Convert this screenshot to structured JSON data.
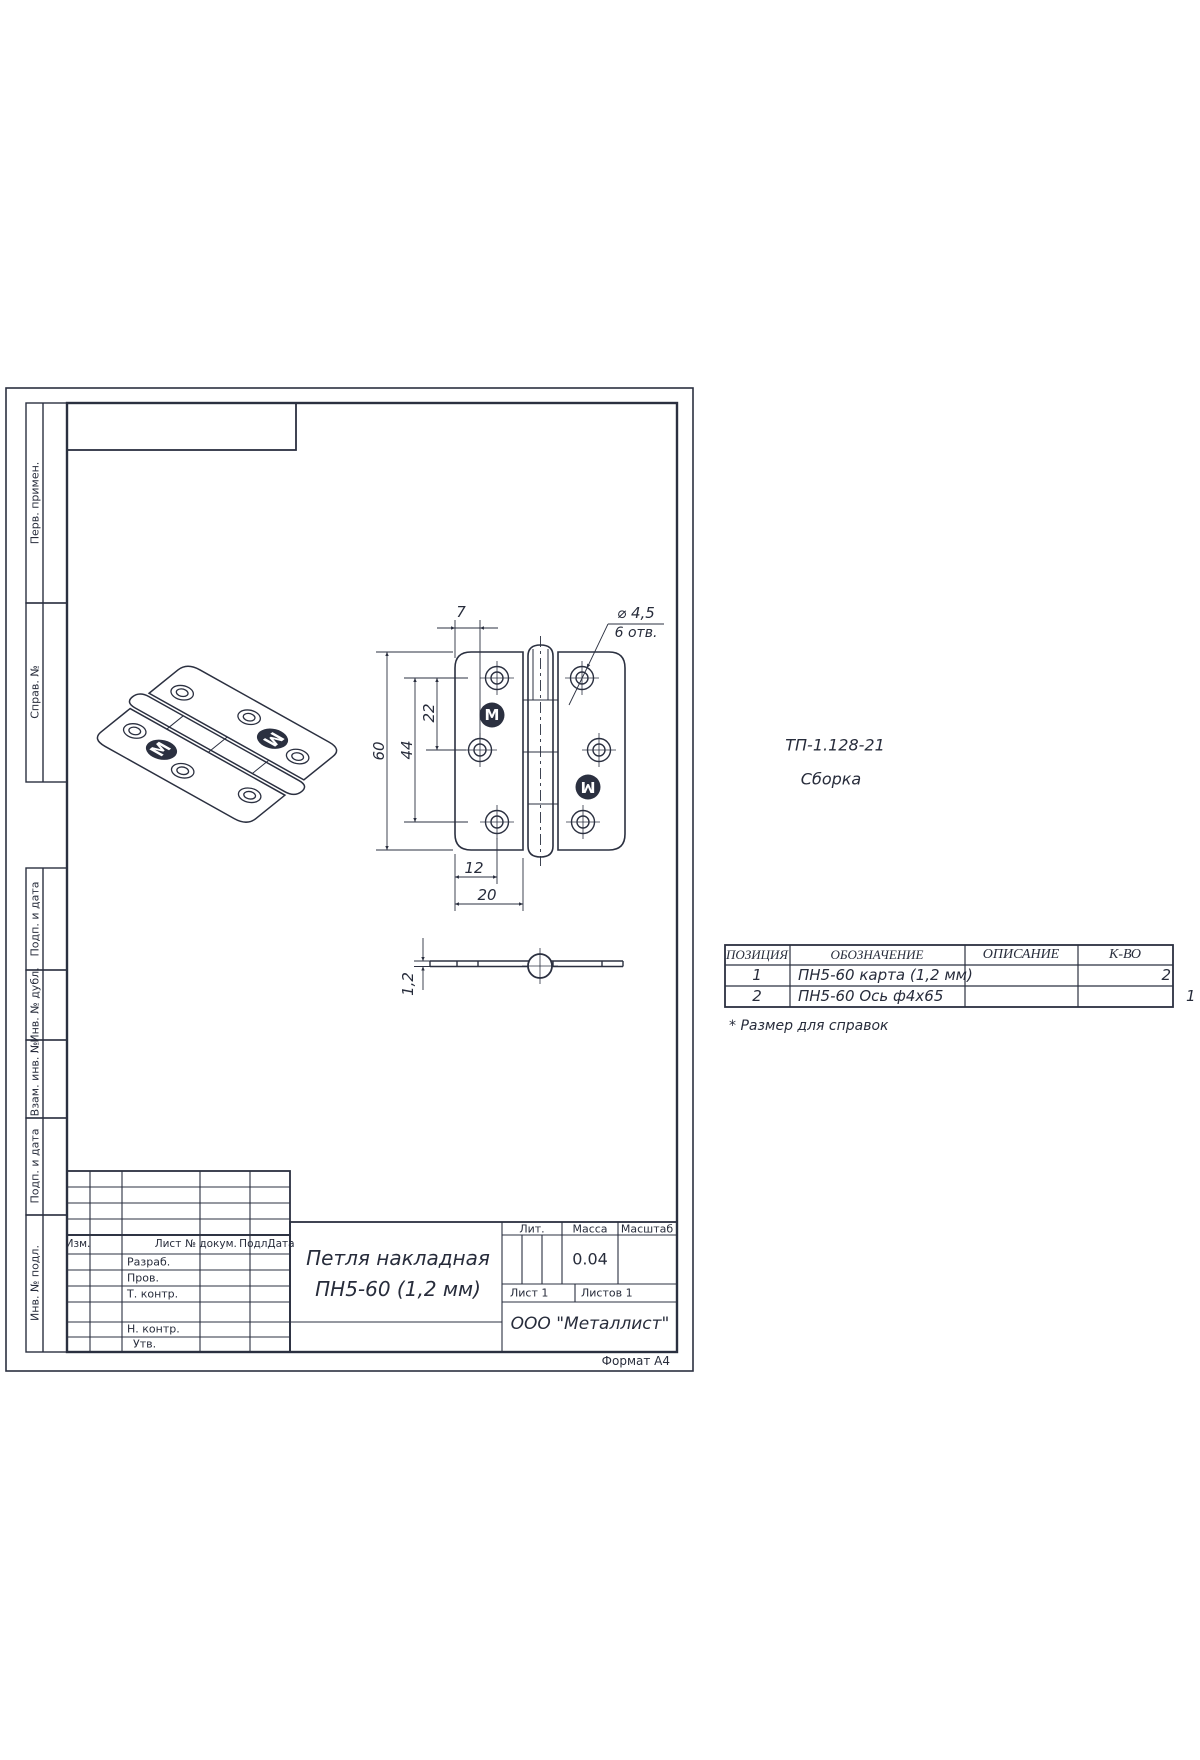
{
  "sheet": {
    "format_note": "Формат А4"
  },
  "margin_labels": [
    "Перв. примен.",
    "Справ. №",
    "Подп. и дата",
    "Инв. № дубл.",
    "Взам. инв. №",
    "Подп. и дата",
    "Инв. № подл."
  ],
  "doc": {
    "code": "ТП-1.128-21",
    "stage": "Сборка"
  },
  "views": {
    "logo_letter": "M"
  },
  "dims": {
    "d7": "7",
    "hole_dia": "⌀ 4,5",
    "hole_count": "6 отв.",
    "d60": "60",
    "d44": "44",
    "d22": "22",
    "d12": "12",
    "d20": "20",
    "d1_2": "1,2"
  },
  "parts_table": {
    "headers": [
      "ПОЗИЦИЯ",
      "ОБОЗНАЧЕНИЕ",
      "ОПИСАНИЕ",
      "К-ВО"
    ],
    "rows": [
      [
        "1",
        "ПН5-60 карта (1,2 мм)",
        "",
        "2"
      ],
      [
        "2",
        "ПН5-60 Ось ф4х65",
        "",
        ""
      ]
    ],
    "qty_outside": "1",
    "footnote": "* Размер для справок"
  },
  "title_block": {
    "header": [
      "Изм.",
      "Лист",
      "№ докум.",
      "Подл.",
      "Дата"
    ],
    "roles": [
      "Разраб.",
      "Пров.",
      "Т. контр.",
      "Н. контр.",
      "Утв."
    ],
    "title1": "Петля накладная",
    "title2": "ПН5-60 (1,2 мм)",
    "lit": "Лит.",
    "mass": "Масса",
    "scale": "Масштаб",
    "mass_value": "0.04",
    "sheet_no": "Лист 1",
    "sheets_total": "Листов 1",
    "company": "ООО \"Металлист\""
  }
}
